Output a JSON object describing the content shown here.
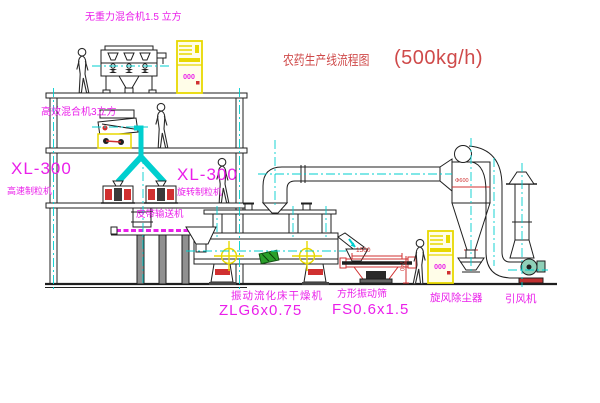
{
  "title": {
    "text_cn": "农药生产线流程图",
    "capacity": "(500kg/h)"
  },
  "equipment_labels": {
    "gravity_free_mixer": "无重力混合机1.5 立方",
    "high_efficiency_mixer": "高效混合机3立方",
    "granulator_left_model": "XL-300",
    "granulator_left_name": "高速制粒机",
    "granulator_right_model": "XL-300",
    "granulator_right_name": "旋转制粒机",
    "belt_conveyor": "皮带输送机",
    "fluid_bed_dryer_name": "振动流化床干燥机",
    "fluid_bed_dryer_model": "ZLG6x0.75",
    "vibrating_sieve_name": "方形振动筛",
    "vibrating_sieve_model": "FS0.6x1.5",
    "cyclone_dust_collector": "旋风除尘器",
    "induced_draft_fan": "引风机"
  },
  "dimensions": {
    "sieve_width": "1500",
    "sieve_height": "740",
    "cyclone_diameter": "Φ600"
  },
  "control_cabinet": {
    "display": "000"
  },
  "colors": {
    "line": "#1f1f1f",
    "centerline_cyan": "#00cfcf",
    "label_magenta": "#ea1fea",
    "dimension_red": "#d03030",
    "cabinet_yellow": "#e8d800",
    "title_red": "#cf4a4a",
    "fan_green": "#8fd0b8",
    "nameplate_green": "#2aa02a"
  }
}
